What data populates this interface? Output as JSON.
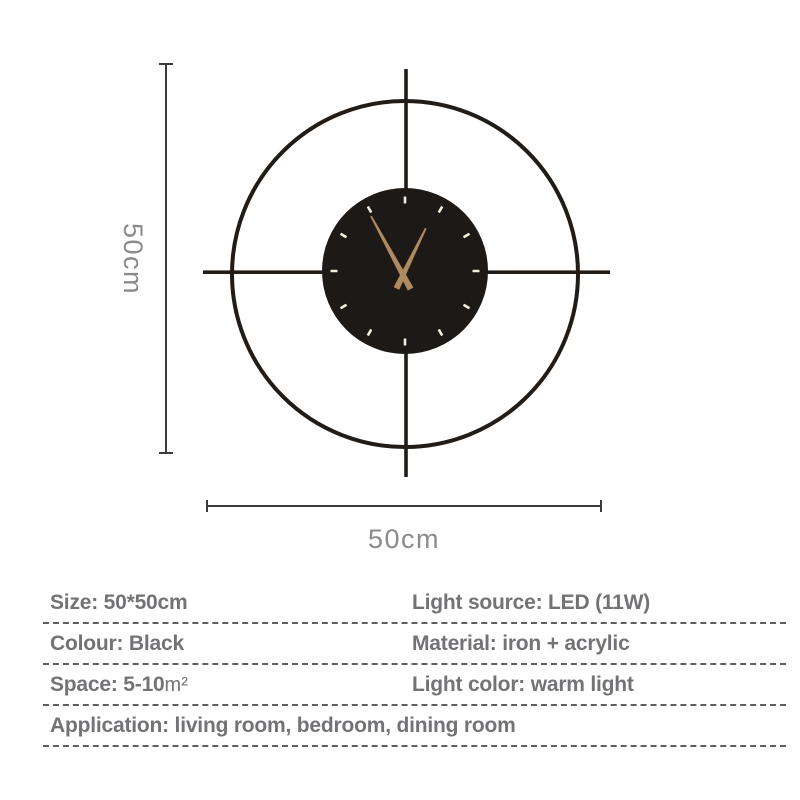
{
  "colors": {
    "page-bg": "#ffffff",
    "clock-metal": "#211c17",
    "clock-face": "#1d1916",
    "hand-color": "#ad8a5f",
    "marker-color": "#f4eddd",
    "dim-line": "#3b3b3b",
    "dim-text": "#8b8b8b",
    "spec-text": "#737377",
    "dash-line": "#5f5f5f"
  },
  "dimensions": {
    "height_label": "50cm",
    "width_label": "50cm"
  },
  "specs": {
    "rows": [
      {
        "left": "Size: 50*50cm",
        "right": "Light source: LED (11W)"
      },
      {
        "left": "Colour: Black",
        "right": "Material: iron + acrylic"
      },
      {
        "left": "Space: 5-10",
        "left_unit": "m²",
        "right": "Light color: warm light"
      },
      {
        "left": "Application: living room, bedroom, dining room"
      }
    ]
  }
}
